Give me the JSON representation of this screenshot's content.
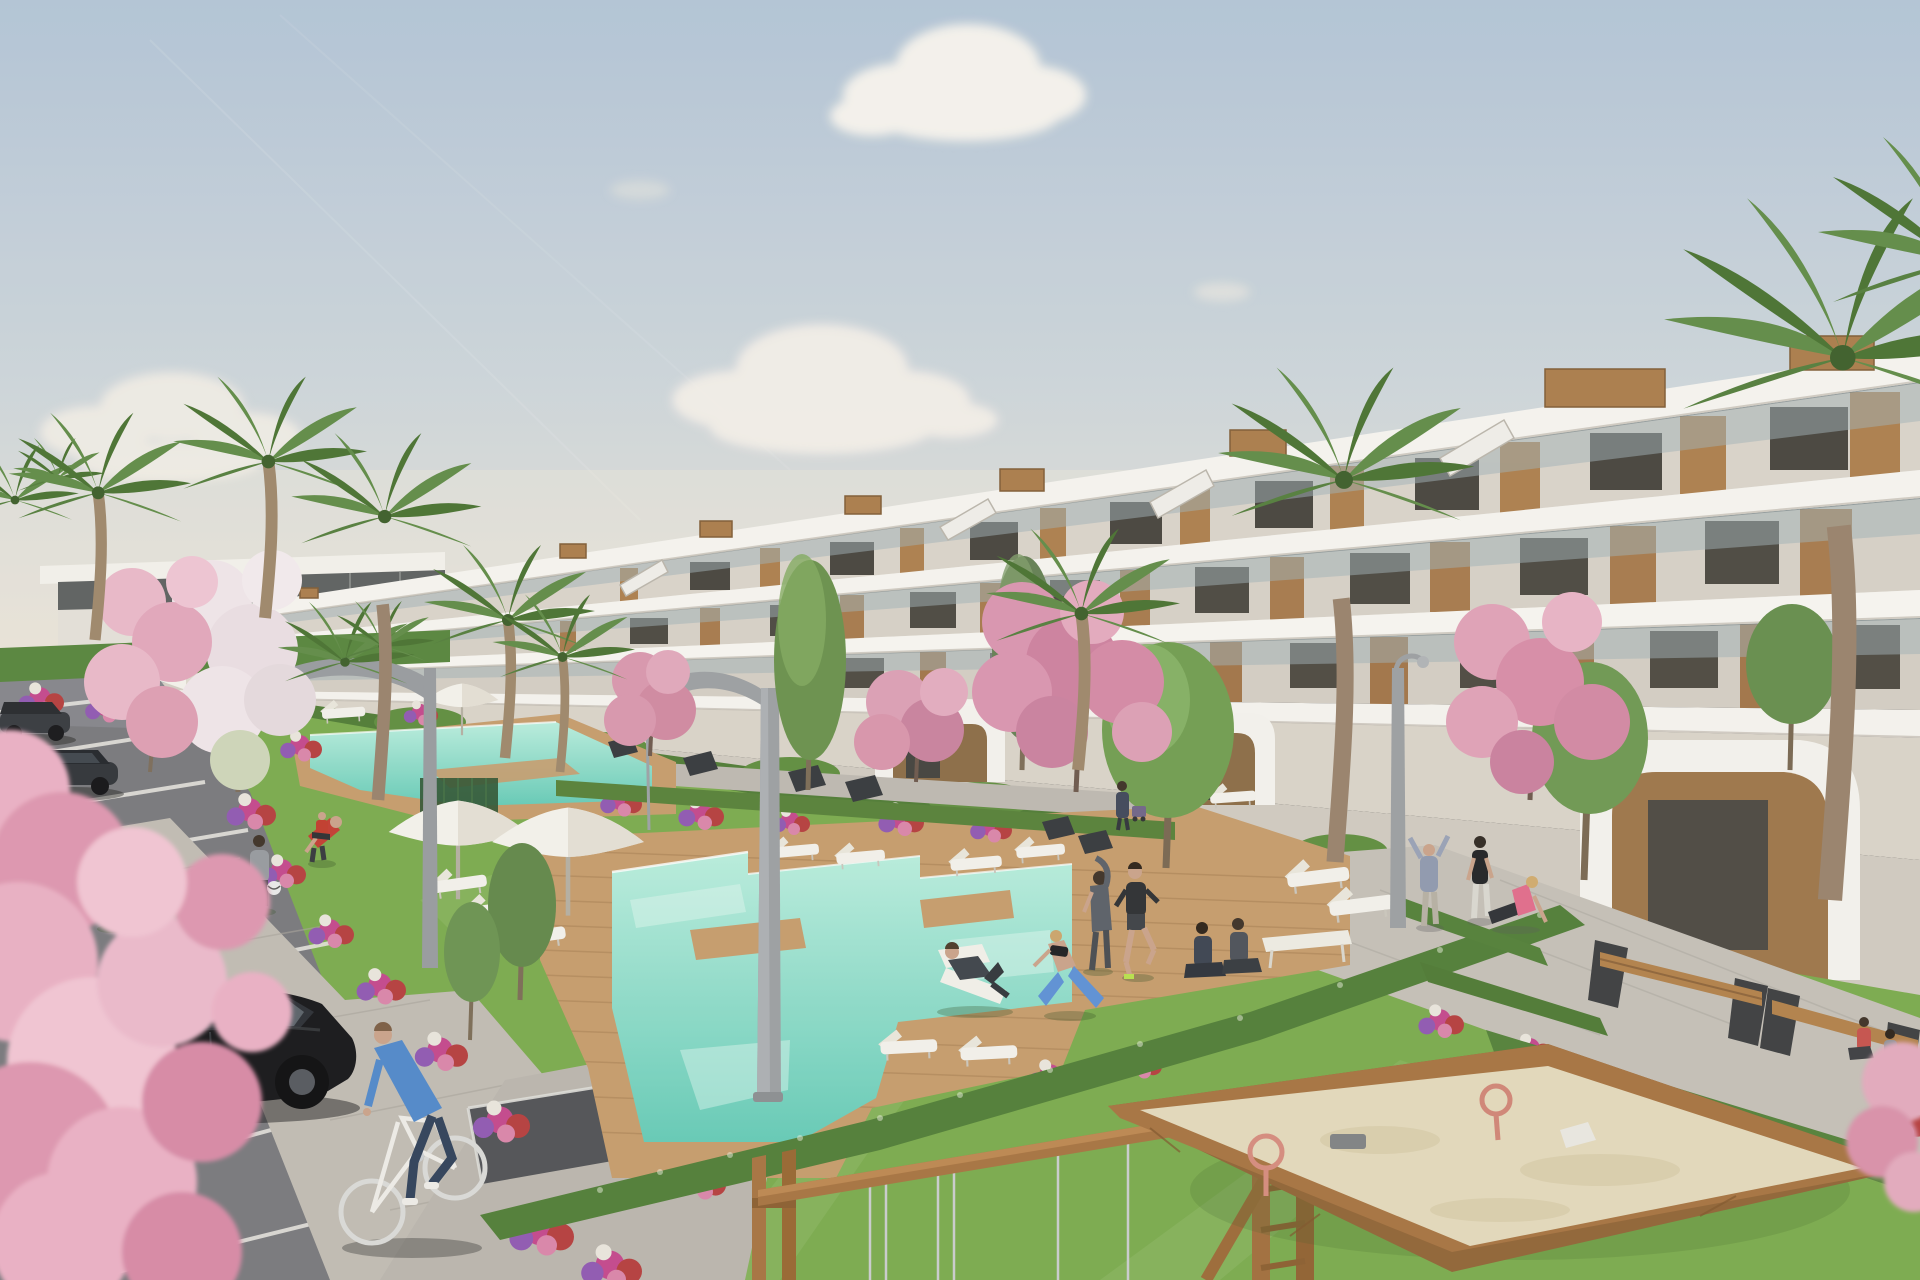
{
  "scene": {
    "type": "architectural-3d-rendering",
    "description": "Sunny 3D render of a modern white terraced apartment complex with wooden panel accents and glass balconies, communal turquoise swimming pools with wooden decks, white umbrellas and sun loungers, landscaped lawns with palm and cherry-blossom trees and flower beds, a parking lot with dark cars, a cyclist on a paved path, people jogging and doing yoga, curved street lamps, and a children's playground with a wooden swing frame and a large sandbox.",
    "time_of_day": "daytime, clear sky with scattered clouds",
    "counts": {
      "apartment_blocks": 1,
      "distant_clubhouse": 1,
      "pools": 2,
      "white_umbrellas": 4,
      "sun_loungers": 14,
      "parked_cars": 3,
      "people": 18,
      "cyclists": 1,
      "palm_trees": 12,
      "blossom_trees": 8,
      "green_trees": 7,
      "street_lamps": 4,
      "benches": 9,
      "playground_items": 2,
      "parking_lines": 8
    }
  },
  "palette": {
    "sky_top": "#b1c3d5",
    "sky_mid": "#ccd4da",
    "sky_horizon": "#e9e1d5",
    "cloud": "#f7f3ed",
    "building_white": "#f5f3ef",
    "building_recess": "#d8d2c9",
    "building_base": "#cfc9bf",
    "wood": "#ab7d4b",
    "wood_dark": "#8d6238",
    "window": "#45423c",
    "glass": "#9fb0b6",
    "grass": "#79a94b",
    "grass_light": "#8fbc5c",
    "grass_dark": "#5f9140",
    "hedge": "#4d7a33",
    "hedge_light": "#6f9c4b",
    "pool_light": "#b8ecdc",
    "pool_deep": "#63c9b5",
    "deck": "#c59a6a",
    "deck_line": "#a37c4e",
    "path": "#bfbab2",
    "asphalt": "#77777b",
    "line_white": "#e8e6e1",
    "blossom": "#e8aec2",
    "blossom_dark": "#d68ba6",
    "blossom_white": "#efe4e8",
    "palm": "#5e8a45",
    "palm_dark": "#47702f",
    "trunk": "#9c8569",
    "flower_magenta": "#c2458b",
    "flower_red": "#b43c3c",
    "flower_purple": "#8e56b0",
    "sand": "#e2d7ba",
    "play_wood": "#a5713f",
    "car_black": "#141417",
    "car_gray": "#34373d",
    "umbrella": "#f3f1ea",
    "skin": "#c9a188"
  }
}
